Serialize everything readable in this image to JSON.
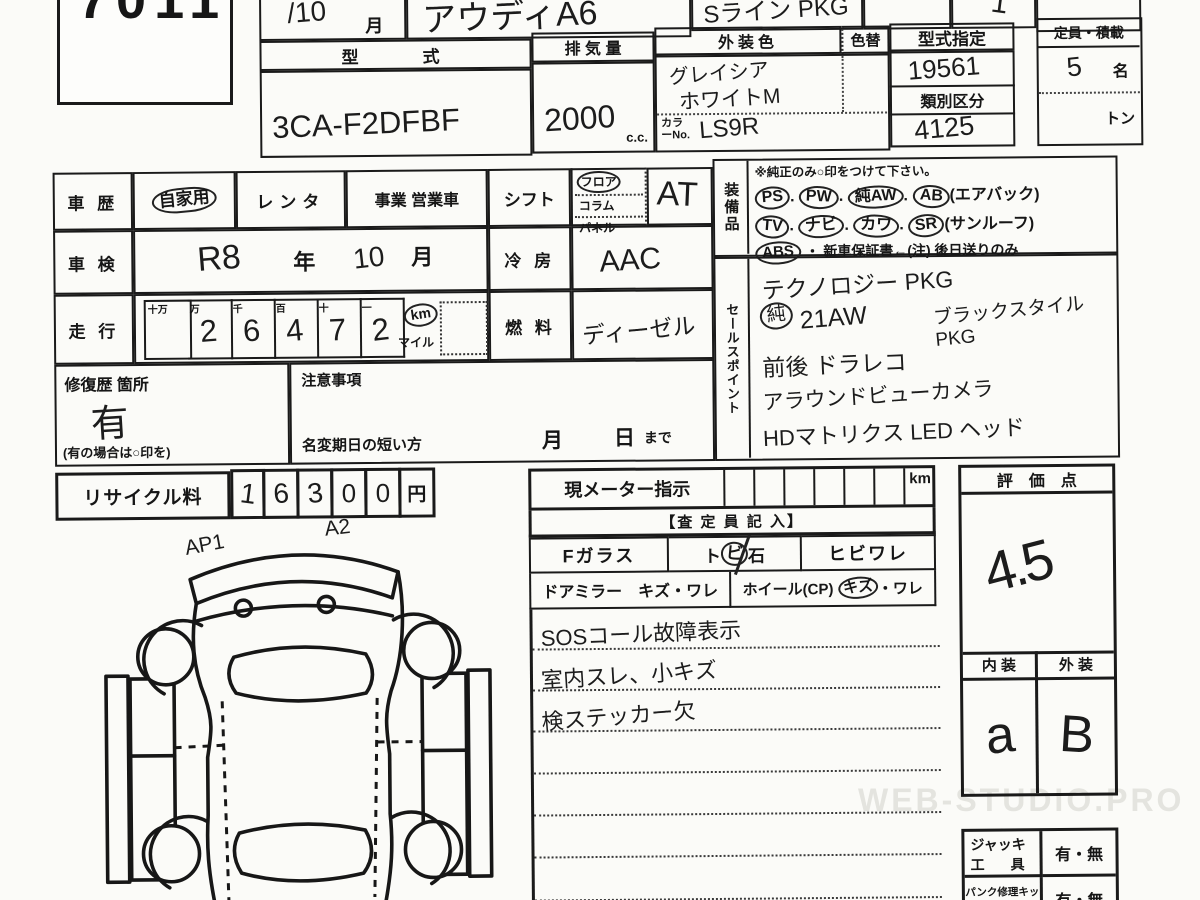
{
  "doc": {
    "lot_number": "7011",
    "month_cell": "/10",
    "month_suffix": "月",
    "car_name": "アウディA6",
    "grade": "Sライン PKG",
    "count_mark": "1"
  },
  "spec": {
    "model_header": "型　　式",
    "model_value": "3CA-F2DFBF",
    "displacement_header": "排 気 量",
    "displacement_value": "2000",
    "displacement_unit": "c.c.",
    "ext_color_header": "外装色",
    "color_change_header": "色替",
    "ext_color_line1": "グレイシア",
    "ext_color_line2": "ホワイトM",
    "color_no_label": "カラーNo.",
    "color_no_value": "LS9R",
    "type_designation_header": "型式指定",
    "type_designation_value": "19561",
    "class_header": "類別区分",
    "class_value": "4125",
    "capacity_header": "定員・積載",
    "capacity_value": "5",
    "capacity_unit": "名",
    "ton_label": "トン"
  },
  "history": {
    "history_label": "車 歴",
    "private": "自家用",
    "rental": "レンタ",
    "business": "事業 営業車",
    "shift_label": "シフト",
    "shift_opt1": "フロア",
    "shift_opt2": "コラム",
    "shift_opt3": "パネル",
    "shift_value": "AT",
    "inspection_label": "車 検",
    "inspection_era": "R8",
    "year_suffix": "年",
    "inspection_month": "10",
    "month_suffix": "月",
    "ac_label": "冷 房",
    "ac_value": "AAC",
    "mileage_label": "走 行",
    "odo_headers": [
      "十万",
      "万",
      "千",
      "百",
      "十",
      "一"
    ],
    "odo_digits": [
      "",
      "2",
      "6",
      "4",
      "7",
      "2"
    ],
    "km_label": "km",
    "mile_label": "マイル",
    "fuel_label": "燃 料",
    "fuel_value": "ディーゼル"
  },
  "repair": {
    "label": "修復歴 箇所",
    "value": "有",
    "note": "(有の場合は○印を)",
    "caution_label": "注意事項",
    "name_change_label": "名変期日の短い方",
    "month_char": "月",
    "day_char": "日",
    "made_label": "まで"
  },
  "recycle": {
    "label": "リサイクル料",
    "digits": [
      "1",
      "6",
      "3",
      "0",
      "0"
    ],
    "unit": "円"
  },
  "equipment": {
    "label": "装備品",
    "note": "※純正のみ○印をつけて下さい。",
    "sep": ".",
    "row1": [
      "PS",
      "PW",
      "純AW",
      "AB"
    ],
    "row1_suffix": "(エアバック)",
    "row2": [
      "TV",
      "ナビ",
      "カワ",
      "SR"
    ],
    "row2_suffix": "(サンルーフ)",
    "row3_item": "ABS",
    "row3_text": "・ 新車保証書←(注) 後日送りのみ"
  },
  "sales_points": {
    "label": "セールスポイント",
    "line1": "テクノロジー PKG",
    "line2_circle": "純",
    "line2": "21AW",
    "line2b": "ブラックスタイルPKG",
    "line3": "前後 ドラレコ",
    "line4": "アラウンドビューカメラ",
    "line5": "HDマトリクス LED ヘッド"
  },
  "meter": {
    "label": "現メーター指示",
    "km_unit": "km",
    "assessor_header": "【査 定 員 記 入】",
    "fglass_label": "Fガラス",
    "fglass_opt1_a": "ト",
    "fglass_opt1_b": "ビ",
    "fglass_opt1_c": "石",
    "fglass_opt2": "ヒビワレ",
    "mirror_label": "ドアミラー　キズ・ワレ",
    "wheel_label": "ホイール(CP)",
    "wheel_opt_circled": "キズ",
    "wheel_opt_rest": "・ワレ",
    "notes": [
      "SOSコール故障表示",
      "室内スレ、小キズ",
      "検ステッカー欠",
      "",
      "",
      "",
      ""
    ]
  },
  "score": {
    "header": "評　価　点",
    "value": "4.5",
    "interior_header": "内 装",
    "exterior_header": "外 装",
    "interior_value": "a",
    "exterior_value": "B"
  },
  "tools": {
    "jack_label1": "ジャッキ",
    "jack_label2": "工　具",
    "jack_options": "有・無",
    "puncture_label": "パンク修理キット",
    "puncture_options": "有・無"
  },
  "diagram": {
    "mark1": "AP1",
    "mark2": "A2"
  },
  "watermark": "WEB-STUDIO.PRO"
}
